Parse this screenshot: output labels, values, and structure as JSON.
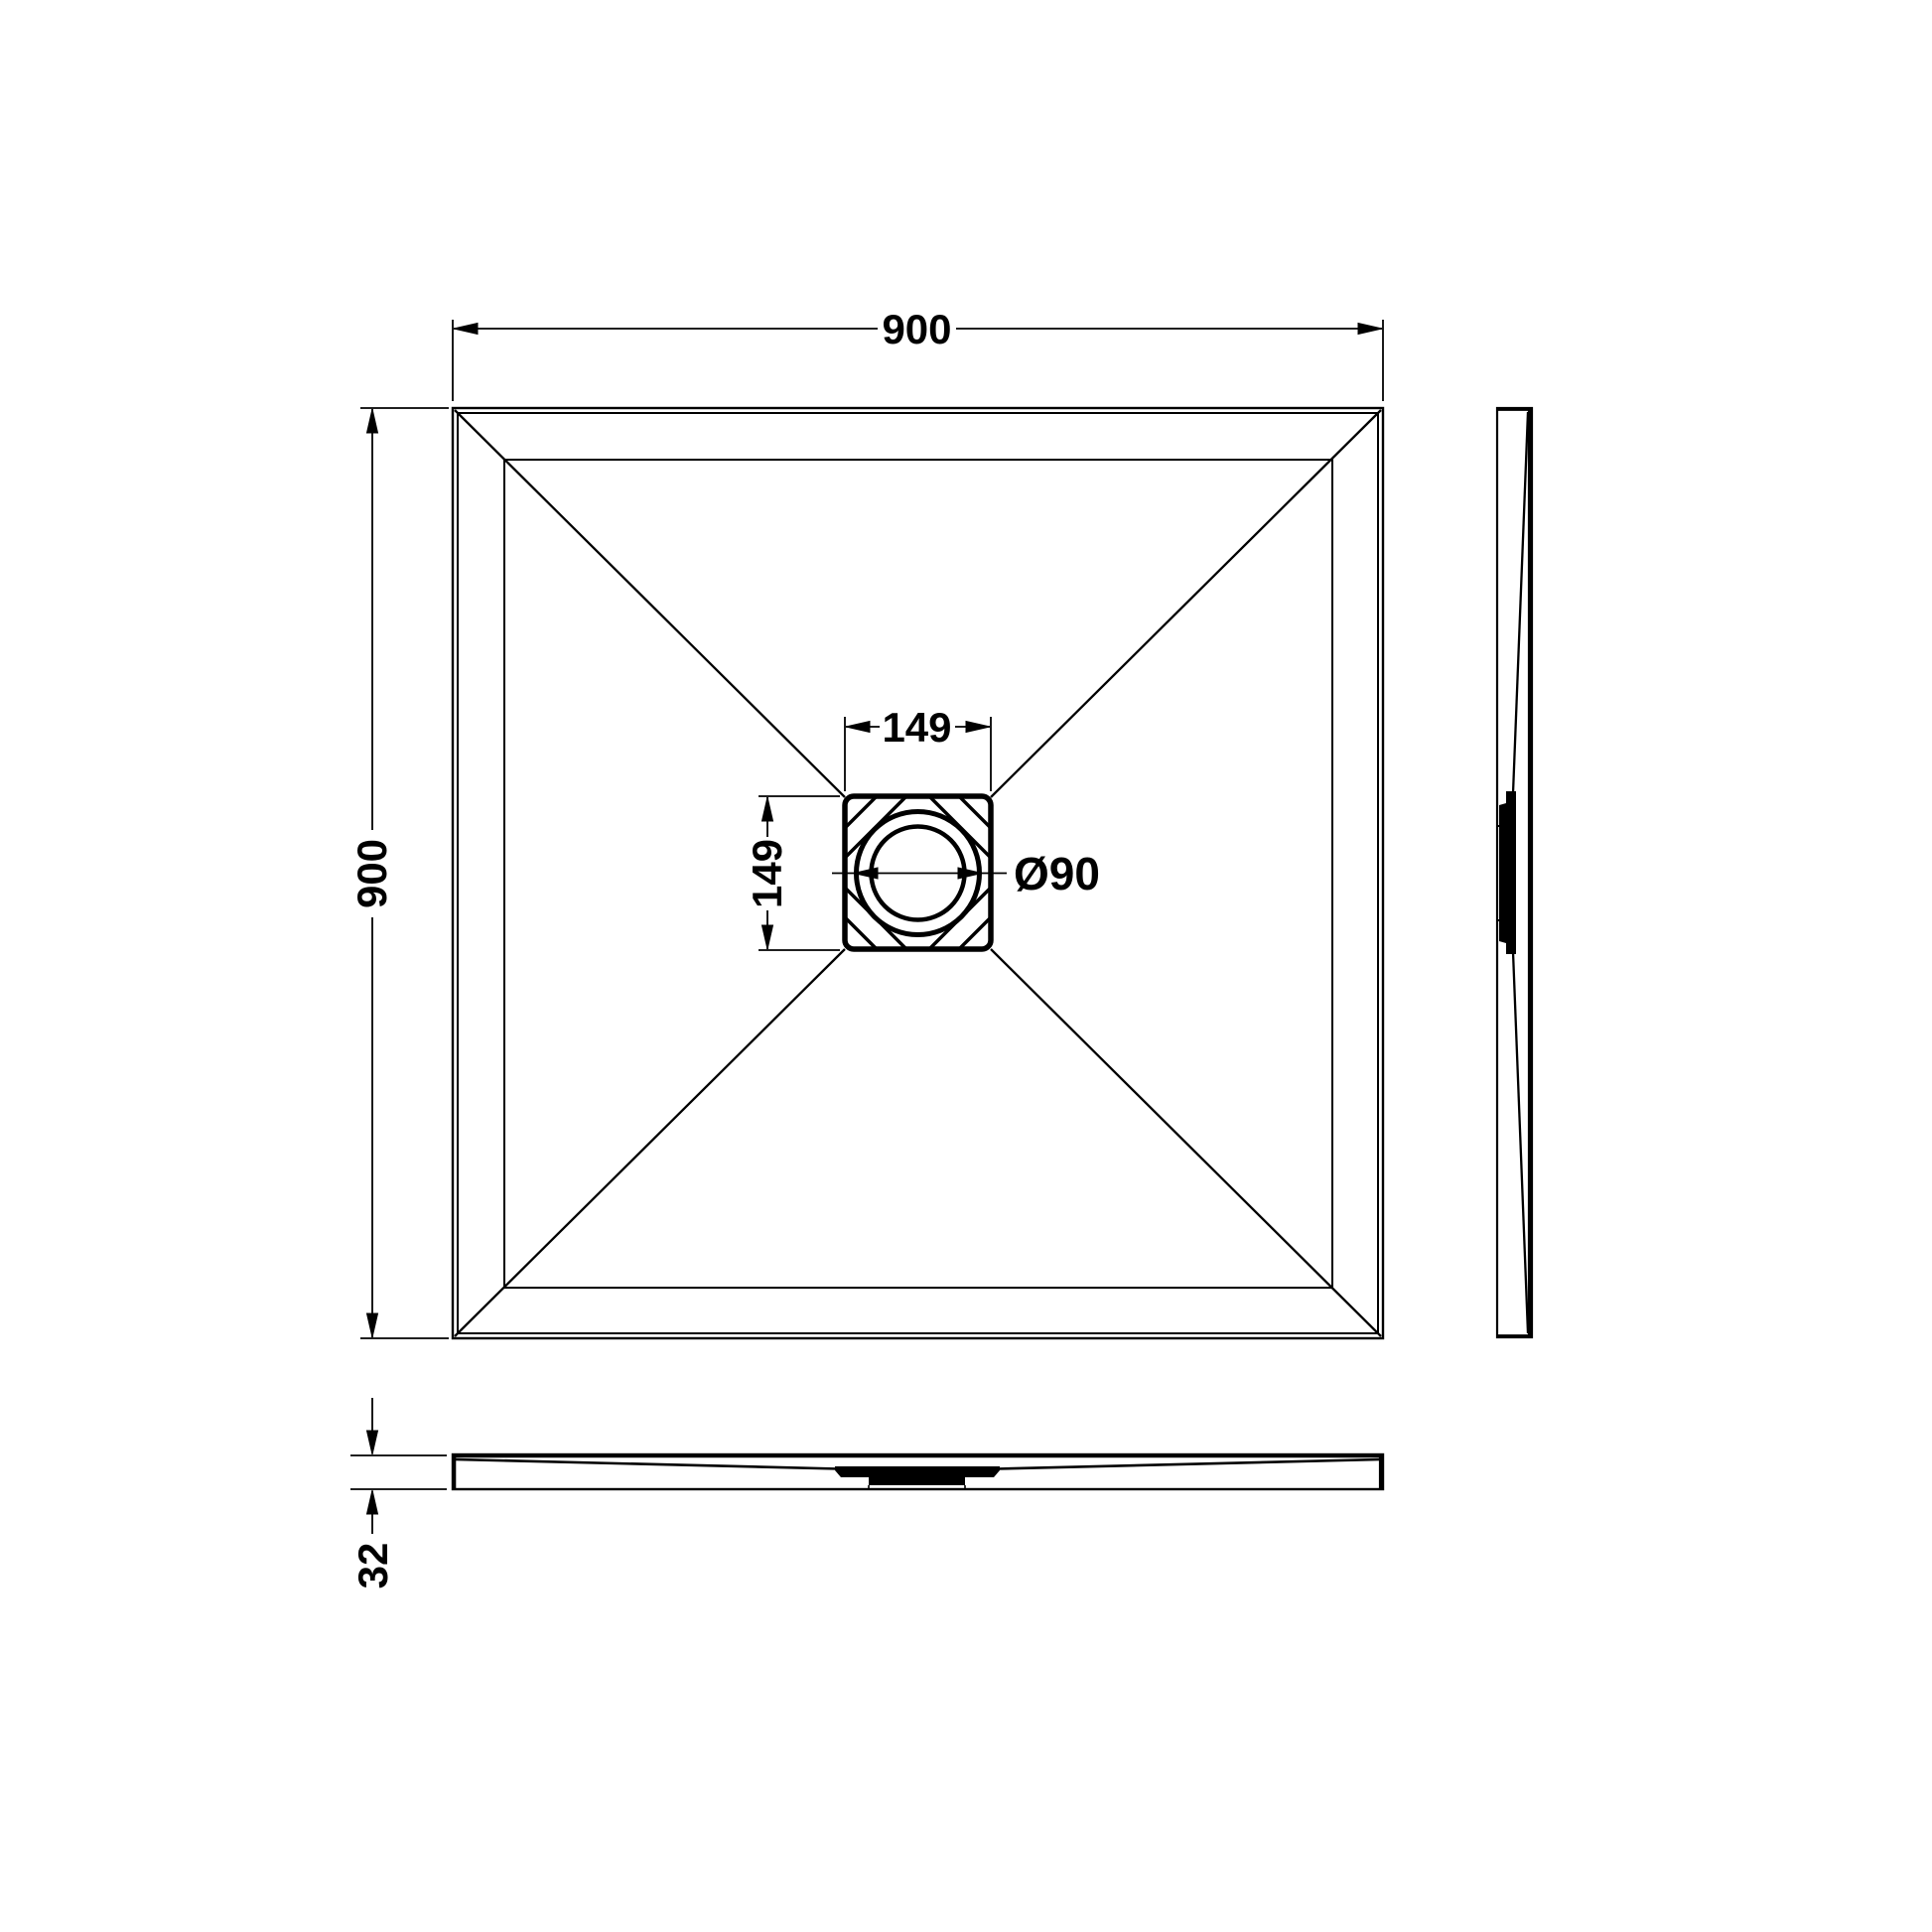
{
  "drawing": {
    "type": "shower-tray-technical-drawing",
    "background_color": "#ffffff",
    "line_color": "#000000",
    "views": {
      "plan": "plan-view",
      "side": "right-side-elevation",
      "front": "front-elevation"
    },
    "dimensions": {
      "overall_width": "900",
      "overall_depth": "900",
      "waste_width": "149",
      "waste_depth": "149",
      "waste_diameter": "Ø90",
      "tray_thickness": "32"
    }
  }
}
